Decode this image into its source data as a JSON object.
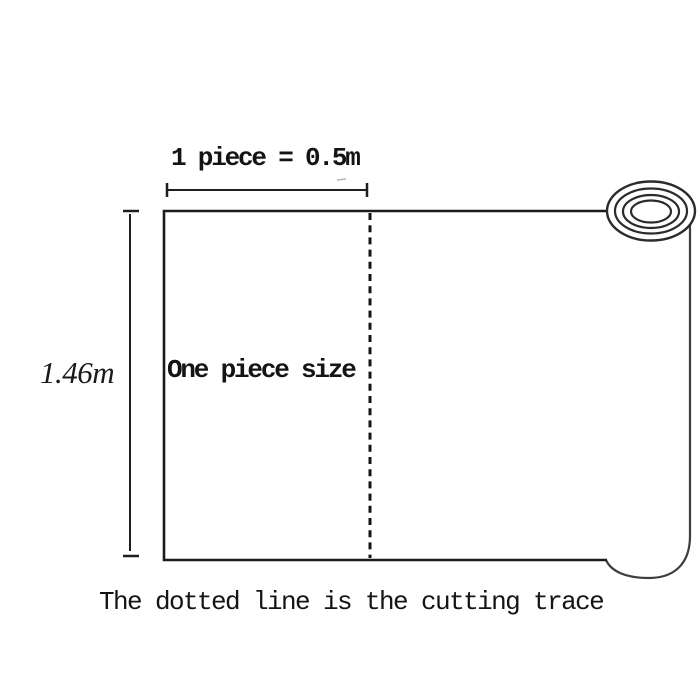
{
  "labels": {
    "top_dimension": "1 piece = 0.5m",
    "height_dimension": "1.46m",
    "piece_size": "One piece size",
    "caption": "The dotted line is the cutting trace"
  },
  "values": {
    "piece_length_m": 0.5,
    "roll_width_m": 1.46
  },
  "icons": {
    "roll_end": "concentric-ellipses-roll-end"
  },
  "colors": {
    "background": "#ffffff",
    "outline": "#1b1b1b",
    "text": "#141414",
    "secondary_line": "#3d3d3d",
    "stray_mark": "#b5b5b5"
  }
}
